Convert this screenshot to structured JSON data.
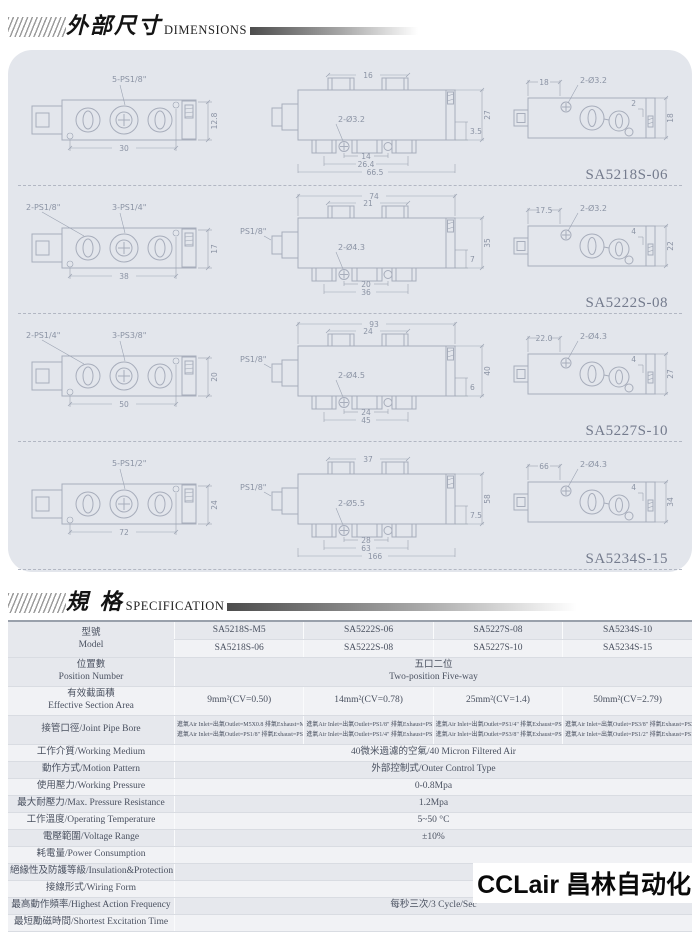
{
  "header1": {
    "title_cjk": "外部尺寸",
    "title_en": "DIMENSIONS"
  },
  "header2": {
    "title_cjk": "規  格",
    "title_en": "SPECIFICATION"
  },
  "logo": "CCLair 昌林自动化",
  "colors": {
    "panel_bg": "#e3e6ec",
    "line": "#a7adbb",
    "accent_dark": "#4d4d4d"
  },
  "drawings": [
    {
      "label": "SA5218S-06",
      "left": {
        "labelA": "",
        "labelB": "5-PS1/8\"",
        "dimBottom": "30",
        "dimRight": "12.8"
      },
      "middle": {
        "portLabel": "",
        "t1": "",
        "t2": "16",
        "hole": "2-Ø3.2",
        "b1": "14",
        "b2": "26.4",
        "b3": "66.5",
        "r1": "3.5",
        "r2": "27"
      },
      "right": {
        "dimTop": "18",
        "hole": "2-Ø3.2",
        "r1": "2",
        "r2": "18"
      }
    },
    {
      "label": "SA5222S-08",
      "left": {
        "labelA": "2-PS1/8\"",
        "labelB": "3-PS1/4\"",
        "dimBottom": "38",
        "dimRight": "17"
      },
      "middle": {
        "portLabel": "PS1/8\"",
        "t1": "74",
        "t2": "21",
        "hole": "2-Ø4.3",
        "b1": "20",
        "b2": "36",
        "b3": "",
        "r1": "7",
        "r2": "35"
      },
      "right": {
        "dimTop": "17.5",
        "hole": "2-Ø3.2",
        "r1": "4",
        "r2": "22"
      }
    },
    {
      "label": "SA5227S-10",
      "left": {
        "labelA": "2-PS1/4\"",
        "labelB": "3-PS3/8\"",
        "dimBottom": "50",
        "dimRight": "20"
      },
      "middle": {
        "portLabel": "PS1/8\"",
        "t1": "93",
        "t2": "24",
        "hole": "2-Ø4.5",
        "b1": "24",
        "b2": "45",
        "b3": "",
        "r1": "6",
        "r2": "40"
      },
      "right": {
        "dimTop": "22.0",
        "hole": "2-Ø4.3",
        "r1": "4",
        "r2": "27"
      }
    },
    {
      "label": "SA5234S-15",
      "left": {
        "labelA": "",
        "labelB": "5-PS1/2\"",
        "dimBottom": "72",
        "dimRight": "24"
      },
      "middle": {
        "portLabel": "PS1/8\"",
        "t1": "",
        "t2": "37",
        "hole": "2-Ø5.5",
        "b1": "28",
        "b2": "63",
        "b3": "166",
        "r1": "7.5",
        "r2": "58"
      },
      "right": {
        "dimTop": "66",
        "hole": "2-Ø4.3",
        "r1": "4",
        "r2": "34"
      }
    }
  ],
  "spec": {
    "model": {
      "label1": "型號",
      "label2": "Model",
      "line1": [
        "SA5218S-M5",
        "SA5222S-06",
        "SA5227S-08",
        "SA5234S-10"
      ],
      "line2": [
        "SA5218S-06",
        "SA5222S-08",
        "SA5227S-10",
        "SA5234S-15"
      ]
    },
    "position": {
      "label1": "位置數",
      "label2": "Position Number",
      "value1": "五口二位",
      "value2": "Two-position Five-way"
    },
    "area": {
      "label1": "有效截面積",
      "label2": "Effective Section Area",
      "values": [
        "9mm²(CV=0.50)",
        "14mm²(CV=0.78)",
        "25mm²(CV=1.4)",
        "50mm²(CV=2.79)"
      ]
    },
    "bore": {
      "label": "接管口徑/Joint Pipe Bore",
      "cells": [
        {
          "l1": "進氣Air Inlet=出氣Outlet=M5X0.8 排氣Exhaust=M5X0.8",
          "l2": "進氣Air Inlet=出氣Outlet=PS1/8\" 排氣Exhaust=PS1/8\""
        },
        {
          "l1": "進氣Air Inlet=出氣Outlet=PS1/8\" 排氣Exhaust=PS1/8\"",
          "l2": "進氣Air Inlet=出氣Outlet=PS1/4\" 排氣Exhaust=PS1/8\""
        },
        {
          "l1": "進氣Air Inlet=出氣Outlet=PS1/4\" 排氣Exhaust=PS1/4\"",
          "l2": "進氣Air Inlet=出氣Outlet=PS3/8\" 排氣Exhaust=PS1/4\""
        },
        {
          "l1": "進氣Air Inlet=出氣Outlet=PS3/8\" 排氣Exhaust=PS3/8\"",
          "l2": "進氣Air Inlet=出氣Outlet=PS1/2\" 排氣Exhaust=PS1/2\""
        }
      ]
    },
    "rows": [
      {
        "label": "工作介質/Working Medium",
        "value": "40微米過濾的空氣/40 Micron Filtered Air"
      },
      {
        "label": "動作方式/Motion Pattern",
        "value": "外部控制式/Outer Control Type"
      },
      {
        "label": "使用壓力/Working Pressure",
        "value": "0-0.8Mpa"
      },
      {
        "label": "最大耐壓力/Max. Pressure Resistance",
        "value": "1.2Mpa"
      },
      {
        "label": "工作溫度/Operating Temperature",
        "value": "5~50 °C"
      },
      {
        "label": "電壓範圍/Voltage Range",
        "value": "±10%"
      },
      {
        "label": "耗電量/Power Consumption",
        "value": ""
      },
      {
        "label": "絕緣性及防護等級/Insulation&Protection Class",
        "value": ""
      },
      {
        "label": "接線形式/Wiring Form",
        "value": ""
      },
      {
        "label": "最高動作頻率/Highest Action Frequency",
        "value": "每秒三次/3 Cycle/Sec"
      },
      {
        "label": "最短勵磁時間/Shortest Excitation Time",
        "value": ""
      }
    ]
  }
}
